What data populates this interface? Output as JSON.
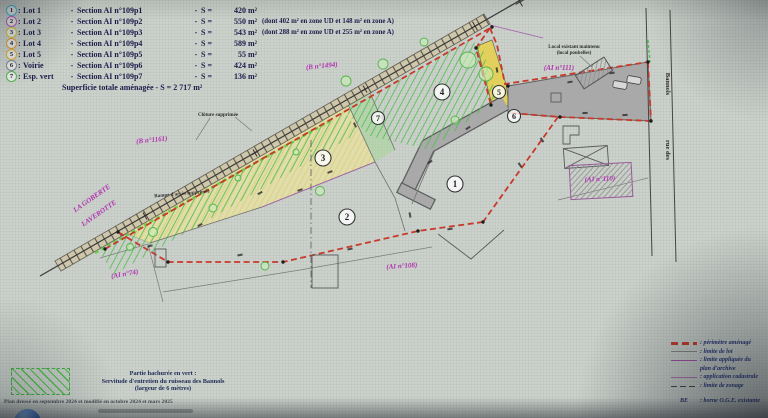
{
  "punct": {
    "colon": ":",
    "dash": "-",
    "eq": "S ="
  },
  "legend": {
    "items": [
      {
        "num": "1",
        "name": "Lot 1",
        "section": "Section AI n°109p1",
        "area": "420 m²",
        "note": "",
        "color": "#45b8d8"
      },
      {
        "num": "2",
        "name": "Lot 2",
        "section": "Section AI n°109p2",
        "area": "550 m²",
        "note": "(dont 402 m² en zone UD et 148 m² en zone A)",
        "color": "#c258c2"
      },
      {
        "num": "3",
        "name": "Lot 3",
        "section": "Section AI n°109p3",
        "area": "543 m²",
        "note": "(dont 288 m² en zone UD et 255 m² en zone A)",
        "color": "#d2c430"
      },
      {
        "num": "4",
        "name": "Lot 4",
        "section": "Section AI n°109p4",
        "area": "589 m²",
        "note": "",
        "color": "#e39a35"
      },
      {
        "num": "5",
        "name": "Lot 5",
        "section": "Section AI n°109p5",
        "area": "55 m²",
        "note": "",
        "color": "#e0ae2e"
      },
      {
        "num": "6",
        "name": "Voirie",
        "section": "Section AI n°109p6",
        "area": "424 m²",
        "note": "",
        "color": "#7d8894"
      },
      {
        "num": "7",
        "name": "Esp. vert",
        "section": "Section AI n°109p7",
        "area": "136 m²",
        "note": "",
        "color": "#54b44a"
      }
    ],
    "total": "Superficie totale aménagée - S = 2 717 m²"
  },
  "plan": {
    "parcel_labels": {
      "b1494": "(B n°1494)",
      "b1161": "(B n°1161)",
      "ai111": "(AI n°111)",
      "ai110": "(AI n°110)",
      "ai108": "(AI n°108)",
      "ai74": "(AI n°74)"
    },
    "place_name_1": "LA GOBERTE",
    "place_name_2": "LAVEROTTE",
    "street_name_1": "rue des",
    "street_name_2": "Bannols",
    "annotations": {
      "cloture": "Clôture supprimée",
      "rampe": "Rampe d'accès supprimée",
      "local_1": "Local existant maintenu",
      "local_2": "(local poubelles)"
    }
  },
  "servitude_box": {
    "line1": "Partie hachurée en vert :",
    "line2": "Servitude d'entretien du ruisseau des Bannols",
    "line3": "(largeur de 6 mètres)"
  },
  "footer": {
    "note": "Plan dressé en septembre 2024 et modifié en octobre 2024 et mars 2025"
  },
  "line_legend": {
    "rows": [
      {
        "style": "red",
        "label": ": périmètre aménagé"
      },
      {
        "style": "gray",
        "label": ": limite de lot"
      },
      {
        "style": "purple",
        "label": ": limite appliquée du"
      },
      {
        "style": "none",
        "label": "plan d'archive"
      },
      {
        "style": "purple2",
        "label": ": application cadastrale"
      },
      {
        "style": "zonage",
        "label": ": limite de zonage"
      },
      {
        "style": "symbol",
        "symbol": "BE",
        "label": ": borne O.G.E. existante"
      }
    ]
  },
  "colors": {
    "perimeter": "#c8392b",
    "magenta": "#b230b2",
    "cadastral": "#a661ae",
    "voirie": "#a9a9a9",
    "servitude": "#4fbf4a",
    "lot3fill": "#e9e2a2",
    "lot5fill": "#e6d049",
    "paper": "#ccd2cb"
  }
}
